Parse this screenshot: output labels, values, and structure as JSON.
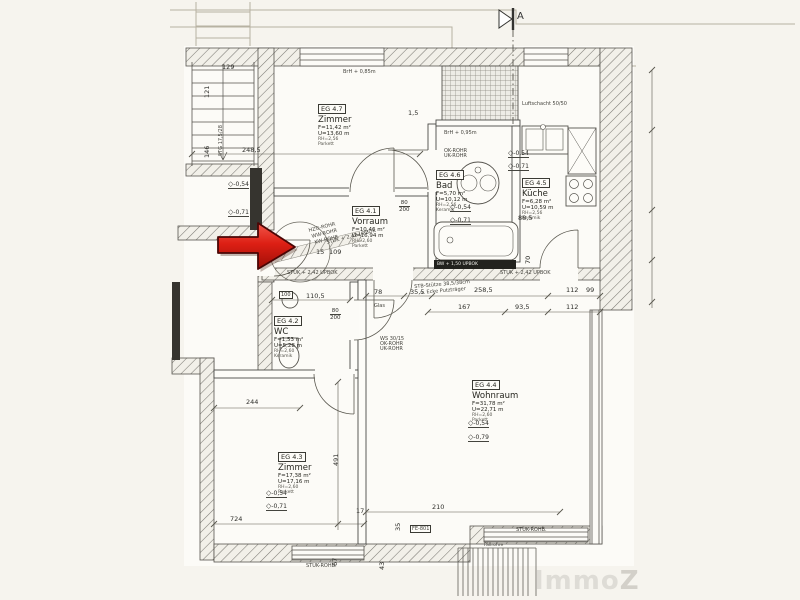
{
  "title": "Grundriss Erdgeschoss Wohnung EG 4",
  "section_marker": {
    "label": "A"
  },
  "symbols": {
    "level": "◇"
  },
  "colors": {
    "arrow_red": "#dd1f14",
    "paper": "#f6f4ee",
    "line": "#4a4a46",
    "watermark": "#dedcd6"
  },
  "watermark": {
    "immo": "Immo",
    "z": "Z"
  },
  "rooms": [
    {
      "id": "EG 4.7",
      "name": "Zimmer",
      "l1": "F=11,42 m²",
      "l2": "U=13,60 m",
      "l3": "RH=2,56",
      "l4": "Parkett"
    },
    {
      "id": "EG 4.6",
      "name": "Bad",
      "l1": "F=5,70 m²",
      "l2": "U=10,12 m",
      "l3": "RH=2,56",
      "l4": "Keramik"
    },
    {
      "id": "EG 4.5",
      "name": "Küche",
      "l1": "F=6,28 m²",
      "l2": "U=10,59 m",
      "l3": "RH=2,56",
      "l4": "Keramik"
    },
    {
      "id": "EG 4.1",
      "name": "Vorraum",
      "l1": "F=10,46 m²",
      "l2": "U=16,94 m",
      "l3": "RH=2,60",
      "l4": "Parkett"
    },
    {
      "id": "EG 4.2",
      "name": "WC",
      "l1": "F=1,53 m²",
      "l2": "U=5,28 m",
      "l3": "RH=2,60",
      "l4": "Keramik"
    },
    {
      "id": "EG 4.4",
      "name": "Wohnraum",
      "l1": "F=31,78 m²",
      "l2": "U=22,71 m",
      "l3": "RH=2,60",
      "l4": "Parkett"
    },
    {
      "id": "EG 4.3",
      "name": "Zimmer",
      "l1": "F=17,38 m²",
      "l2": "U=17,16 m",
      "l3": "RH=2,60",
      "l4": "Parkett"
    }
  ],
  "dims": [
    "248,5",
    "110,5",
    "78",
    "35,5",
    "258,5",
    "112",
    "167",
    "93,5",
    "112",
    "88,5",
    "70",
    "244",
    "491",
    "724",
    "210",
    "129",
    "121",
    "146",
    "1,5",
    "15",
    "109",
    "100",
    "67",
    "43",
    "17",
    "35",
    "99"
  ],
  "levels": [
    "-0,54",
    "-0,71",
    "-0,54",
    "-0,71",
    "-0,54",
    "-0,71",
    "-0,54",
    "-0,79",
    "-0,54",
    "-0,71"
  ],
  "doors": [
    {
      "w": "80",
      "h": "200"
    },
    {
      "w": "80",
      "h": "200"
    }
  ],
  "annotations": [
    "STUK + 2,42 UPBOK",
    "STUK + 2,42 UPBOK",
    "STUK + 2,42 UPBOK",
    "STB-Stütze 38,5/38cm",
    "u. Ecke Putzträger",
    "Luftschacht 50/50",
    "BrH + 0,85m",
    "BrH + 0,95m",
    "OK-ROHR",
    "UK-ROHR",
    "WS 30/15",
    "OK-ROHR",
    "UK-ROHR",
    "HZG-ROHR",
    "WW-ROHR",
    "KW-ROHR",
    "Fallrohre",
    "FE-801",
    "STUK-ROHB.",
    "STUK-ROHB.",
    "Glas",
    "STG 17,5/28",
    "BW + 1,50 UPBOK"
  ]
}
